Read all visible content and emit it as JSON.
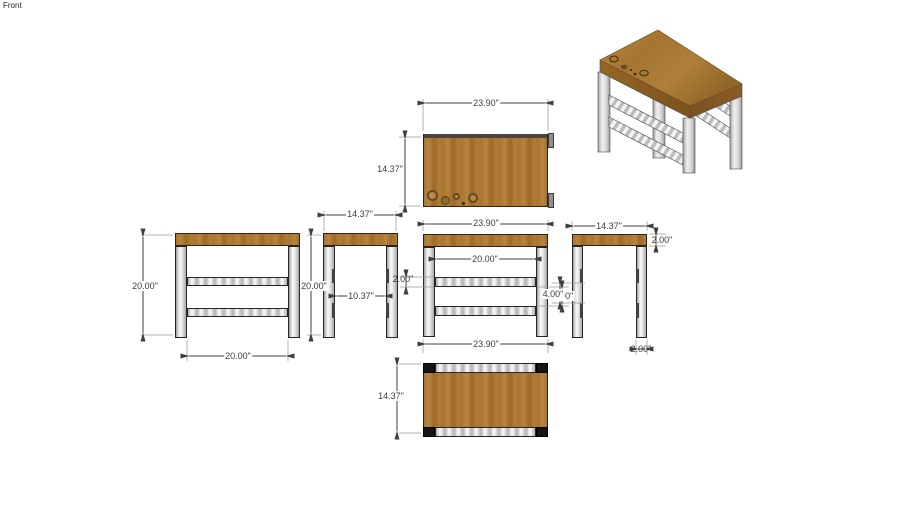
{
  "app": {
    "scene_label": "Front"
  },
  "drawing": {
    "subject": "workbench orthographic views with dimensions",
    "views": {
      "top": {
        "title": "top view",
        "width": "23.90\"",
        "depth": "14.37\""
      },
      "front": {
        "title": "front view",
        "height": "20.00\"",
        "leg_span": "20.00\""
      },
      "side_left": {
        "title": "side view",
        "width": "14.37\"",
        "height": "20.00\"",
        "leg_gap": "10.37\""
      },
      "front_center": {
        "title": "front view",
        "width": "23.90\"",
        "leg_span": "20.00\"",
        "rail_thickness": "2.00\"",
        "rail_gap": "4.00\"",
        "bottom_width": "23.90\""
      },
      "side_right": {
        "title": "side view",
        "width": "14.37\"",
        "top_thickness": "2.00\"",
        "rail_gap": "4.00\"",
        "leg_width": "2.00\""
      },
      "bottom": {
        "title": "bottom view",
        "depth": "14.37\""
      },
      "perspective": {
        "title": "3d view"
      }
    },
    "colors": {
      "wood": "#a9752f",
      "wood_edge_dark": "#7a5220",
      "leg_gray": "#d9d9d9",
      "rail_stripe": "#b0b0b0",
      "outline": "#262626",
      "dimension": "#3f3f3f",
      "background": "#ffffff"
    }
  }
}
